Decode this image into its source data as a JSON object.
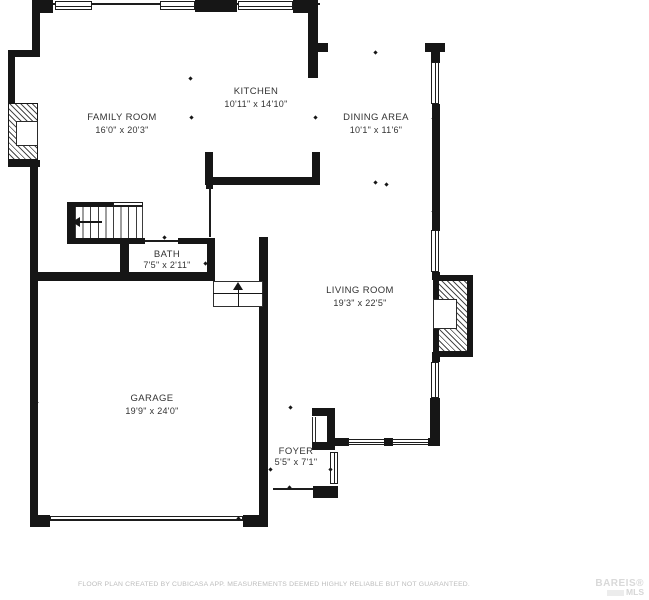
{
  "rooms": [
    {
      "name": "FAMILY ROOM",
      "dims": "16'0\" x 20'3\""
    },
    {
      "name": "KITCHEN",
      "dims": "10'11\" x 14'10\""
    },
    {
      "name": "DINING AREA",
      "dims": "10'1\" x 11'6\""
    },
    {
      "name": "LIVING ROOM",
      "dims": "19'3\" x 22'5\""
    },
    {
      "name": "BATH",
      "dims": "7'5\" x 2'11\""
    },
    {
      "name": "GARAGE",
      "dims": "19'9\" x 24'0\""
    },
    {
      "name": "FOYER",
      "dims": "5'5\" x 7'1\""
    }
  ],
  "footer": {
    "disclaimer": "FLOOR PLAN CREATED BY CUBICASA APP. MEASUREMENTS DEEMED HIGHLY RELIABLE BUT NOT GUARANTEED."
  },
  "watermark": {
    "line1": "BAREIS®",
    "line2": "MLS"
  },
  "colors": {
    "wall": "#161616",
    "label_text": "#333333",
    "disclaimer_text": "#bcbcbc",
    "watermark_text": "#d9d9d9"
  }
}
